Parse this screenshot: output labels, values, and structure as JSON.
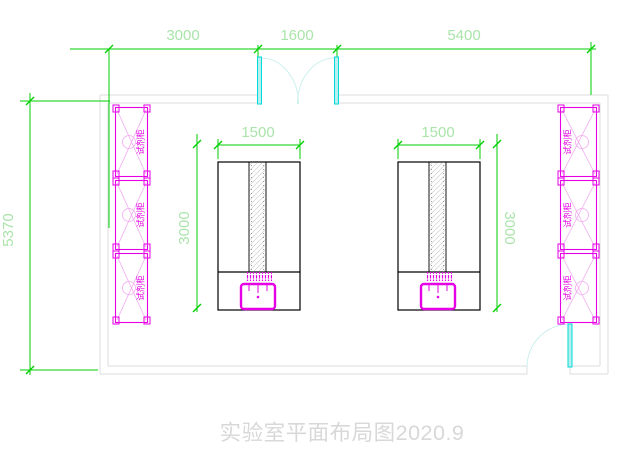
{
  "title": {
    "text": "实验室平面布局图2020.9"
  },
  "dimensions": {
    "top": [
      "3000",
      "1600",
      "5400"
    ],
    "overall_height": "5370",
    "bench_width": "1500",
    "bench_depth": "3000"
  },
  "labels": {
    "reagent_cabinet": "试剂柜"
  },
  "colors": {
    "dimension_line": "#00cf00",
    "dimension_text": "#aae4aa",
    "wall": "#dcdcdc",
    "door_leaf": "#00d9d9",
    "door_arc": "#cdf0ee",
    "equipment_magenta": "#e500e5",
    "bench_outline": "#000000",
    "title_text": "#d8d8d8"
  }
}
